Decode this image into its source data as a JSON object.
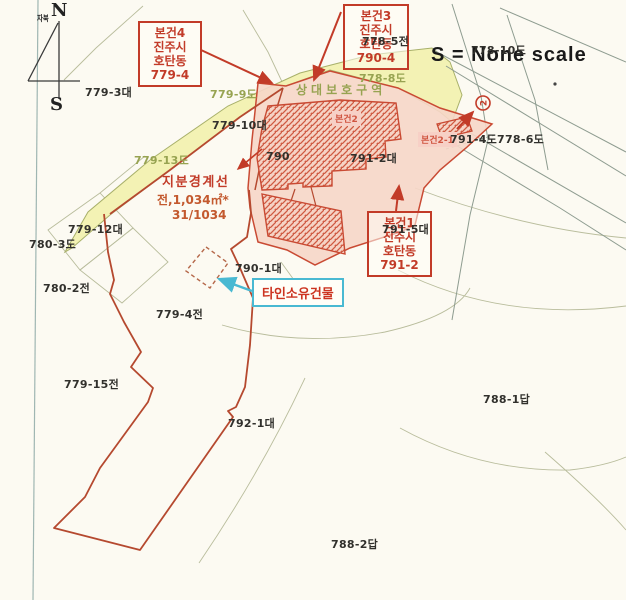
{
  "scale_note": "S  = None scale",
  "compass": {
    "north": "N",
    "south": "S",
    "declination": "자북"
  },
  "callouts": {
    "site4": {
      "lines": [
        "본건4",
        "진주시",
        "호탄동",
        "779-4"
      ]
    },
    "site3": {
      "lines": [
        "본건3",
        "진주시",
        "호탄동",
        "790-4"
      ]
    },
    "site1": {
      "lines": [
        "본건1",
        "진주시",
        "호탄동",
        "791-2"
      ]
    },
    "other_owner_building": "타인소유건물"
  },
  "share_boundary": {
    "title": "지분경계선",
    "area": "전,1,034㎡*",
    "fraction": "31/1034"
  },
  "building_tags": {
    "bldg2": "본건2",
    "bldg2_1": "본건2-1"
  },
  "zone_label": "상대보호구역",
  "parcels": {
    "p779_3": "779-3대",
    "p778_5": "778-5전",
    "p778_10": "778-10도",
    "p779_10": "779-10대",
    "p791_2": "791-2대",
    "p791_4": "791-4도",
    "p778_6": "778-6도",
    "p791_5": "791-5대",
    "p790": "790",
    "p779_12": "779-12대",
    "p780_3": "780-3도",
    "p780_2": "780-2전",
    "p790_1": "790-1대",
    "p779_4": "779-4전",
    "p779_15": "779-15전",
    "p792_1": "792-1대",
    "p788_1": "788-1답",
    "p788_2": "788-2답",
    "p779_9": "779-9도",
    "p779_13": "779-13도",
    "p778_8": "778-8도"
  },
  "symbols": {
    "circle_mark": "2"
  },
  "colors": {
    "road_band": "#f3f2b4",
    "subject_area": "#f6d6c8",
    "boundary_red": "#b5492f",
    "callout_red": "#c23b28",
    "cyan_accent": "#49b9d2",
    "green_label": "#97a351"
  }
}
